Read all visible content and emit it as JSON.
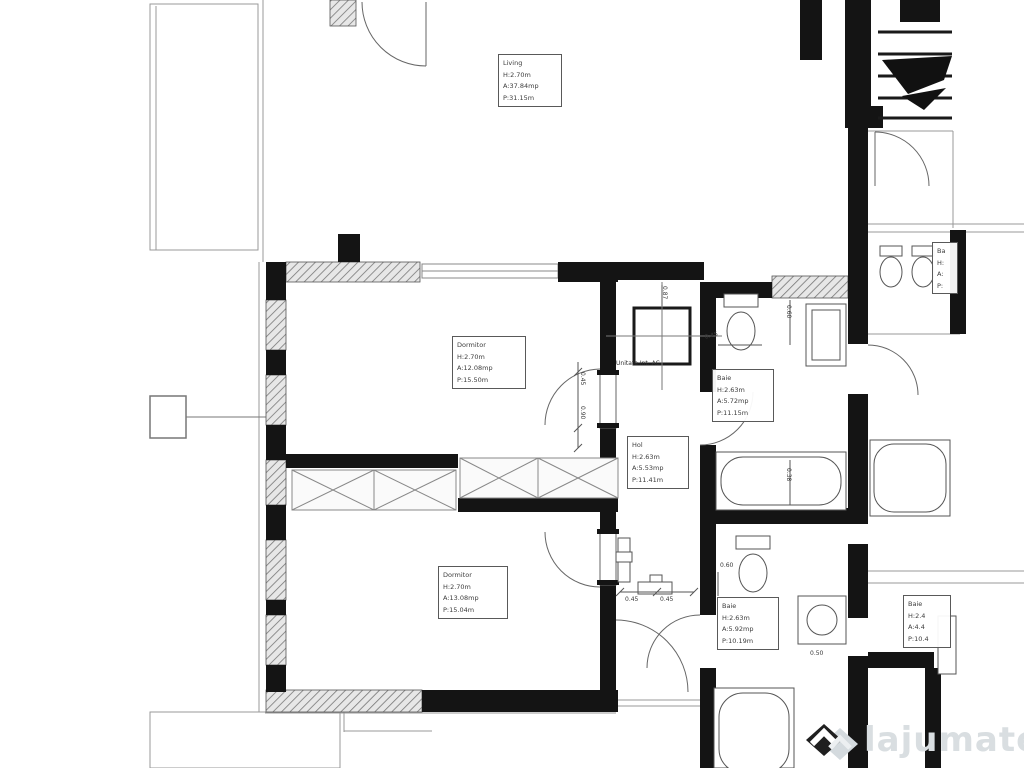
{
  "rooms": {
    "living": {
      "name": "Living",
      "h": "H:2.70m",
      "a": "A:37.84mp",
      "p": "P:31.15m"
    },
    "dormitor1": {
      "name": "Dormitor",
      "h": "H:2.70m",
      "a": "A:12.08mp",
      "p": "P:15.50m"
    },
    "hol": {
      "name": "Hol",
      "h": "H:2.63m",
      "a": "A:5.53mp",
      "p": "P:11.41m"
    },
    "baie1": {
      "name": "Baie",
      "h": "H:2.63m",
      "a": "A:5.72mp",
      "p": "P:11.15m"
    },
    "dormitor2": {
      "name": "Dormitor",
      "h": "H:2.70m",
      "a": "A:13.08mp",
      "p": "P:15.04m"
    },
    "baie2": {
      "name": "Baie",
      "h": "H:2.63m",
      "a": "A:5.92mp",
      "p": "P:10.19m"
    },
    "baie3": {
      "name": "Baie",
      "h": "H:2.4",
      "a": "A:4.4",
      "p": "P:10.4"
    },
    "neighbor": {
      "name": "Ba",
      "h": "H:",
      "a": "A:",
      "p": "P:"
    }
  },
  "labels": {
    "ac_unit": "Unitate Int. AC"
  },
  "dims": {
    "wc1": "0.45",
    "vanity1": "0.60",
    "tub1": "0.38",
    "hall_left": "0.45",
    "hall_right": "0.45",
    "door_top": "0.45",
    "door_bottom": "0.90",
    "wc2": "0.60",
    "washer": "0.50",
    "hol_top": "0.87"
  },
  "watermark": {
    "brand": "lajumate",
    "tld": ".ro"
  },
  "colors": {
    "wall": "#141414",
    "thin_line": "#999999",
    "label_border": "#595959",
    "watermark_text": "#d9dee1",
    "watermark_tld": "#b7d6ec"
  }
}
